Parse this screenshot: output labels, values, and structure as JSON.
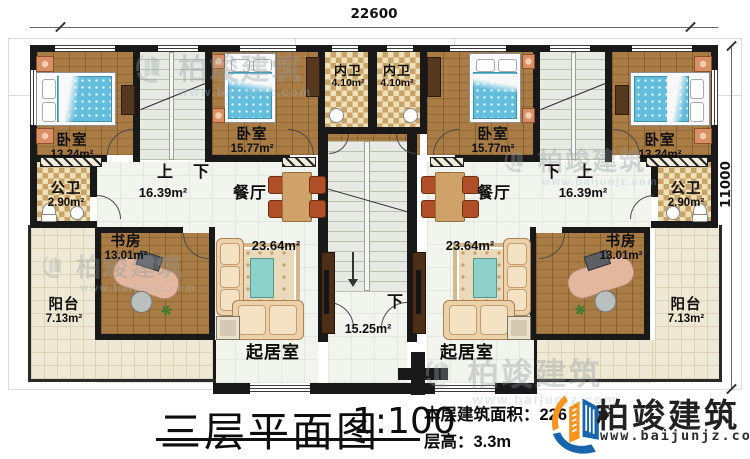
{
  "dimensions": {
    "top_width": "22600",
    "right_height": "11000"
  },
  "stair_labels": {
    "left_up": "上",
    "left_down": "下",
    "right_down": "下",
    "right_up": "上",
    "center_down": "下"
  },
  "rooms": {
    "bedroom_tl": {
      "name": "卧室",
      "area": "13.24m²"
    },
    "bedroom_tl2": {
      "name": "卧室",
      "area": "15.77m²"
    },
    "bath_inner_l": {
      "name": "内卫",
      "area": "4.10m²"
    },
    "bath_inner_r": {
      "name": "内卫",
      "area": "4.10m²"
    },
    "bedroom_tr2": {
      "name": "卧室",
      "area": "15.77m²"
    },
    "bedroom_tr": {
      "name": "卧室",
      "area": "13.24m²"
    },
    "bath_public_l": {
      "name": "公卫",
      "area": "2.90m²"
    },
    "bath_public_r": {
      "name": "公卫",
      "area": "2.90m²"
    },
    "hall_l": {
      "area": "16.39m²"
    },
    "hall_r": {
      "area": "16.39m²"
    },
    "dining_l": {
      "name": "餐厅"
    },
    "dining_r": {
      "name": "餐厅"
    },
    "study_l": {
      "name": "书房",
      "area": "13.01m²"
    },
    "study_r": {
      "name": "书房",
      "area": "13.01m²"
    },
    "balcony_l": {
      "name": "阳台",
      "area": "7.13m²"
    },
    "balcony_r": {
      "name": "阳台",
      "area": "7.13m²"
    },
    "living_l": {
      "name": "起居室",
      "area": "23.64m²"
    },
    "living_r": {
      "name": "起居室",
      "area": "23.64m²"
    },
    "stair_hall": {
      "area": "15.25m²"
    }
  },
  "titleblock": {
    "title": "三层平面图",
    "scale": "1:100",
    "area_label": "本层建筑面积：",
    "area_value": "226",
    "area_unit": "m²",
    "height_label": "层高：",
    "height_value": "3.3m"
  },
  "logo": {
    "name": "柏竣建筑",
    "url": "www.baijunjz.com",
    "blue": "#1766ad",
    "orange": "#f7941d"
  },
  "watermark": {
    "name": "柏竣建筑",
    "url": "www.baijunjz.com"
  }
}
